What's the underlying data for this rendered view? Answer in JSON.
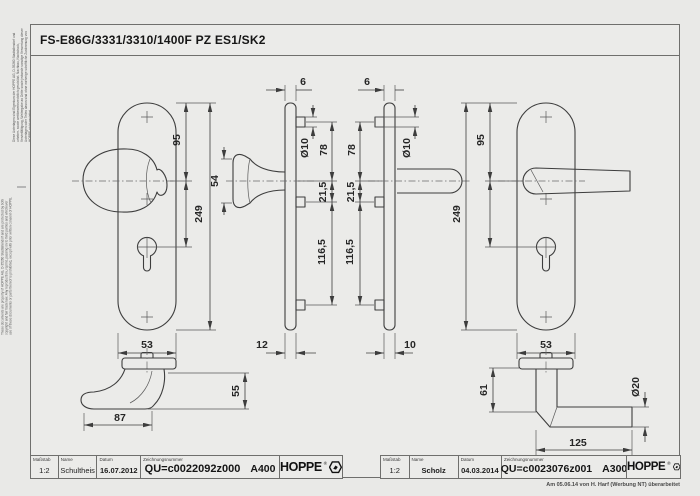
{
  "header": {
    "title": "FS-E86G/3331/3310/1400F PZ ES1/SK2"
  },
  "margin_notes": {
    "german": "Diese Unterlagen sind Eigentum der HOPPE AG, D-35260 Stadtallendorf und urheber- sowie wettbewerbsrechtlich geschützt. Nachbau, Nachdruck, Vervielfältigung, Weitergabe an Dritte sowie jedwede sonstige Verwertung dieser Unterlagen oder Teilen davon sind ohne vorherige schriftliche Zustimmung von HOPPE nicht gestattet.",
    "english": "These documents are property of HOPPE AG, D-35260 Stadtallendorf and are protected by both copyright and fair trade law. Any reproduction, reprint, passing on to third parties and whichever use of these documents or parts thereof is prohibited, except with prior written consent of HOPPE."
  },
  "dims": {
    "knob_plate": {
      "to_center": "95",
      "height": "249",
      "width": "53"
    },
    "knob_side": {
      "thickness": "6",
      "boss_dia": "Ø10",
      "top_to_center": "78",
      "center_to_boss": "21,5",
      "boss_span": "116,5",
      "knob_height": "54",
      "depth": "12"
    },
    "lever_side": {
      "thickness": "6",
      "boss_dia": "Ø10",
      "top_to_center": "78",
      "center_to_boss": "21,5",
      "boss_span": "116,5",
      "depth": "10"
    },
    "lever_plate": {
      "to_center": "95",
      "height": "249",
      "width": "53"
    },
    "knob_top": {
      "length": "87",
      "height": "55"
    },
    "lever_top": {
      "depth": "61",
      "length": "125",
      "grip_dia": "Ø20"
    }
  },
  "title_block": {
    "headers": {
      "scale": "Maßstab",
      "name": "Name",
      "date": "Datum",
      "drawing_number": "Zeichnungsnummer"
    },
    "left": {
      "scale": "1:2",
      "name": "Schultheis",
      "date": "16.07.2012",
      "drawing_number": "QU=c0022092z000",
      "revision_code": "A400",
      "brand": "HOPPE",
      "registered": "®"
    },
    "right": {
      "scale": "1:2",
      "name": "Scholz",
      "date": "04.03.2014",
      "drawing_number": "QU=c0023076z001",
      "revision_code": "A300",
      "brand": "HOPPE",
      "registered": "®"
    }
  },
  "footer": {
    "revision_note": "Am 05.06.14 von H. Harf (Werbung NT) überarbeitet"
  }
}
